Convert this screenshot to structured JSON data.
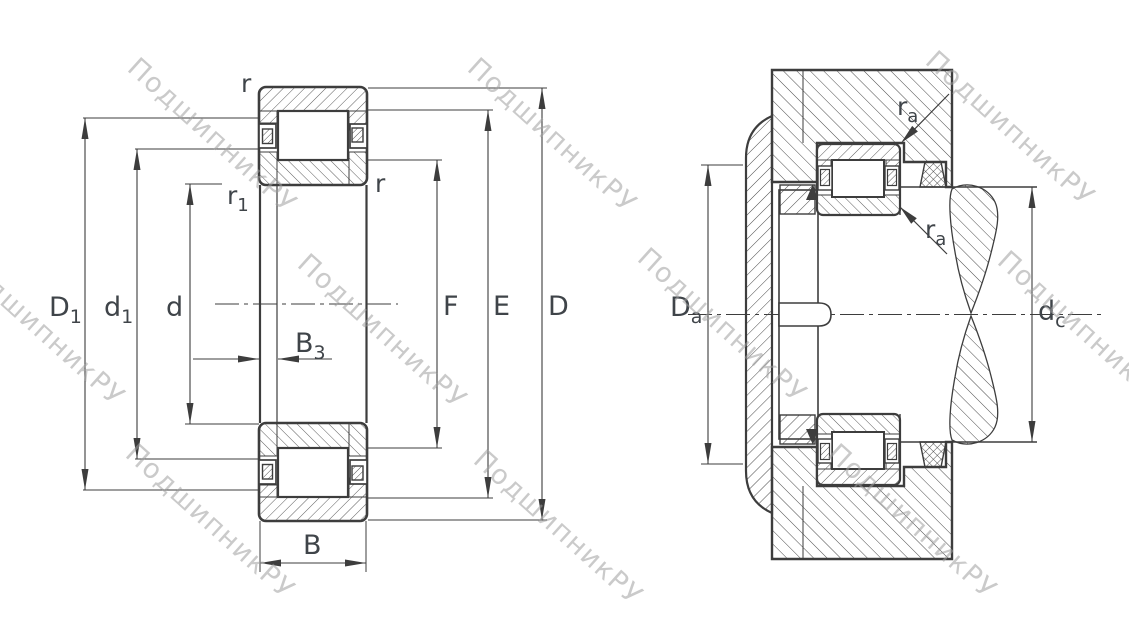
{
  "watermark": {
    "text": "ПодшипникРУ"
  },
  "labels": {
    "r_top": {
      "main": "r",
      "sub": ""
    },
    "r1": {
      "main": "r",
      "sub": "1"
    },
    "r_inner": {
      "main": "r",
      "sub": ""
    },
    "D1": {
      "main": "D",
      "sub": "1"
    },
    "d1": {
      "main": "d",
      "sub": "1"
    },
    "d": {
      "main": "d",
      "sub": ""
    },
    "B3": {
      "main": "B",
      "sub": "3"
    },
    "B": {
      "main": "B",
      "sub": ""
    },
    "F": {
      "main": "F",
      "sub": ""
    },
    "E": {
      "main": "E",
      "sub": ""
    },
    "D": {
      "main": "D",
      "sub": ""
    },
    "Da": {
      "main": "D",
      "sub": "a"
    },
    "ra_top": {
      "main": "r",
      "sub": "a"
    },
    "ra_mid": {
      "main": "r",
      "sub": "a"
    },
    "dc": {
      "main": "d",
      "sub": "c"
    }
  }
}
